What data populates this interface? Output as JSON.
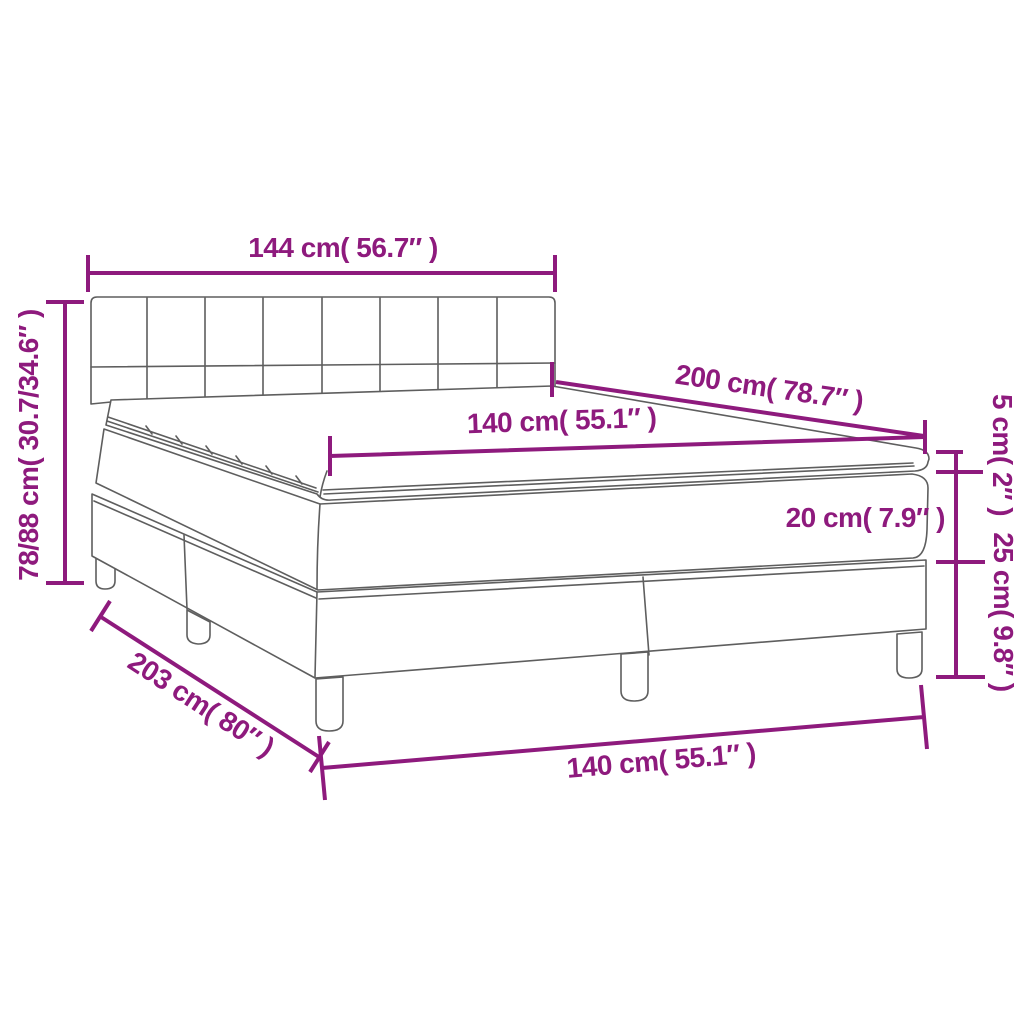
{
  "diagram": {
    "title": "box-spring-bed-dimension-diagram",
    "colors": {
      "accent": "#8E1A7D",
      "line": "#5E5E5E",
      "background": "#FFFFFF"
    },
    "labels": {
      "headboard_width": "144 cm( 56.7″ )",
      "bed_height": "78/88 cm( 30.7/34.6″ )",
      "mattress_length": "200 cm( 78.7″ )",
      "mattress_width": "140 cm( 55.1″ )",
      "topper_height": "5 cm( 2″ )",
      "mattress_height": "20 cm( 7.9″ )",
      "base_height": "25 cm( 9.8″ )",
      "bed_length": "203 cm( 80″ )",
      "bed_width": "140 cm( 55.1″ )"
    }
  }
}
